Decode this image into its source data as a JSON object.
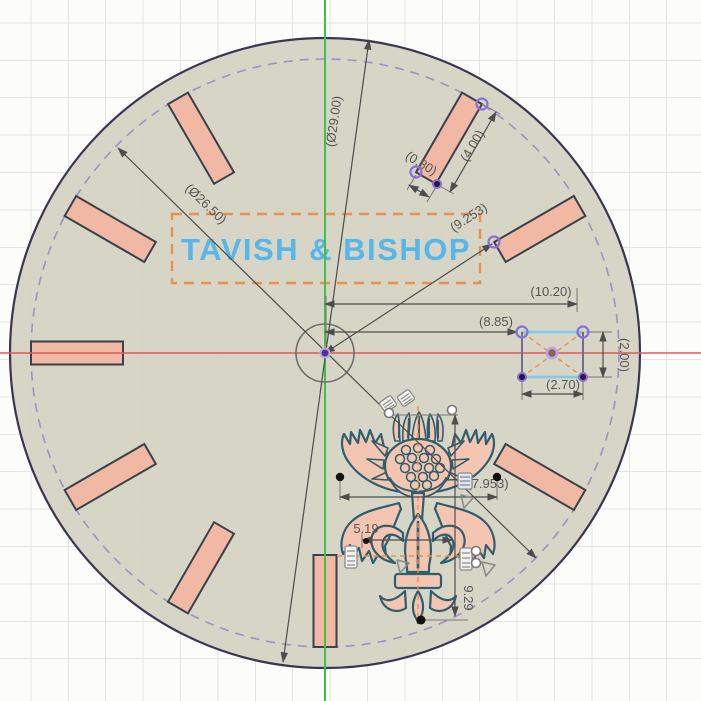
{
  "app": {
    "name": "cad-sketch-viewport",
    "description": "watch dial sketch with hour markers, date window, logo and thistle emblem"
  },
  "colors": {
    "canvas_bg": "#fcfcfb",
    "grid_line": "#e3e3e0",
    "dial_fill": "#d5d2c2",
    "circle_stroke": "#3b3554",
    "dashed_stroke": "#9a92c8",
    "marker_fill": "#f1b9a3",
    "marker_stroke": "#39404e",
    "axis_x_red": "#e05a5a",
    "axis_y_green": "#3fc24a",
    "logo_color": "#58b6e8",
    "frame_orange": "#e8914e",
    "selection_purple": "#8a6fd8",
    "emblem_stroke": "#2e5e70",
    "emblem_fill": "#f4c6b1",
    "dimension_text": "#565656"
  },
  "sketch": {
    "dial": {
      "center": {
        "x": 325,
        "y": 353
      },
      "outer_radius": 315,
      "dashed_radius": 294,
      "marker_angles_deg": [
        30,
        60,
        120,
        180,
        210,
        240,
        270,
        300,
        330
      ],
      "marker_width": 23,
      "marker_inner_r": 202,
      "marker_outer_r": 294
    },
    "logo": {
      "text": "TAVISH & BISHOP"
    },
    "dimensions": {
      "outer_diameter": "(Ø29.00)",
      "marker_ring_diameter": "(Ø26.50)",
      "marker_corner_distance": "(9.253)",
      "date_window_offset_far": "(10.20)",
      "date_window_offset_near": "(8.85)",
      "date_window_width": "(2.70)",
      "date_window_height": "(2.00)",
      "marker_length": "(4.00)",
      "marker_width": "(0.80)",
      "emblem_width": "(7.953)",
      "fleur_width": "5.19",
      "emblem_height": "9.29"
    },
    "glyphs": [
      "fix-constraint-icon",
      "symmetry-constraint-icon",
      "open-endpoint",
      "constrained-point",
      "origin-point"
    ]
  }
}
